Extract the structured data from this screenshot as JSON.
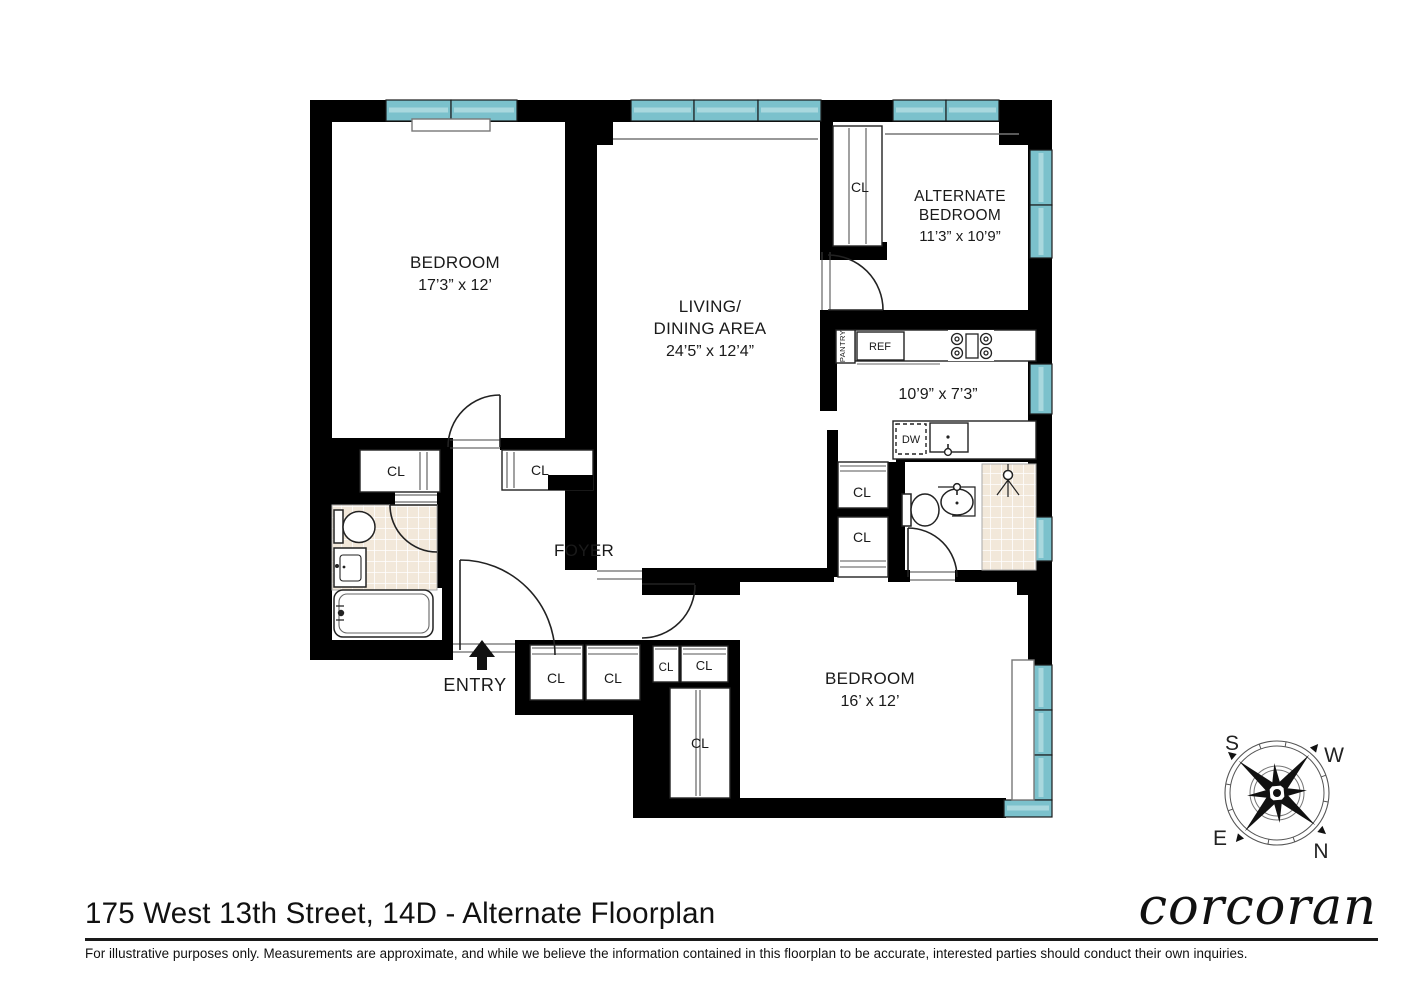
{
  "title": "175 West 13th Street, 14D - Alternate Floorplan",
  "disclaimer": "For illustrative purposes only.  Measurements are approximate, and while we believe the information contained in this floorplan to be accurate, interested parties should conduct their own inquiries.",
  "brand": "corcoran",
  "compass": {
    "north": "N",
    "south": "S",
    "east": "E",
    "west": "W"
  },
  "rooms": {
    "bedroom1": {
      "name": "BEDROOM",
      "dims": "17’3” x 12’"
    },
    "living": {
      "name_line1": "LIVING/",
      "name_line2": "DINING AREA",
      "dims": "24’5” x 12’4”"
    },
    "alt_bedroom": {
      "name_line1": "ALTERNATE",
      "name_line2": "BEDROOM",
      "dims": "11’3” x 10’9”"
    },
    "kitchen": {
      "dims": "10’9” x 7’3”"
    },
    "foyer": {
      "name": "FOYER"
    },
    "bedroom2": {
      "name": "BEDROOM",
      "dims": "16’ x 12’"
    },
    "entry": {
      "name": "ENTRY"
    }
  },
  "labels": {
    "closet": "CL",
    "refrigerator": "REF",
    "dishwasher": "DW",
    "pantry": "PANTRY"
  },
  "colors": {
    "wall": "#000000",
    "window": "#7bc1cc",
    "window_light": "#a9d8de",
    "tile": "#f2e8da"
  }
}
